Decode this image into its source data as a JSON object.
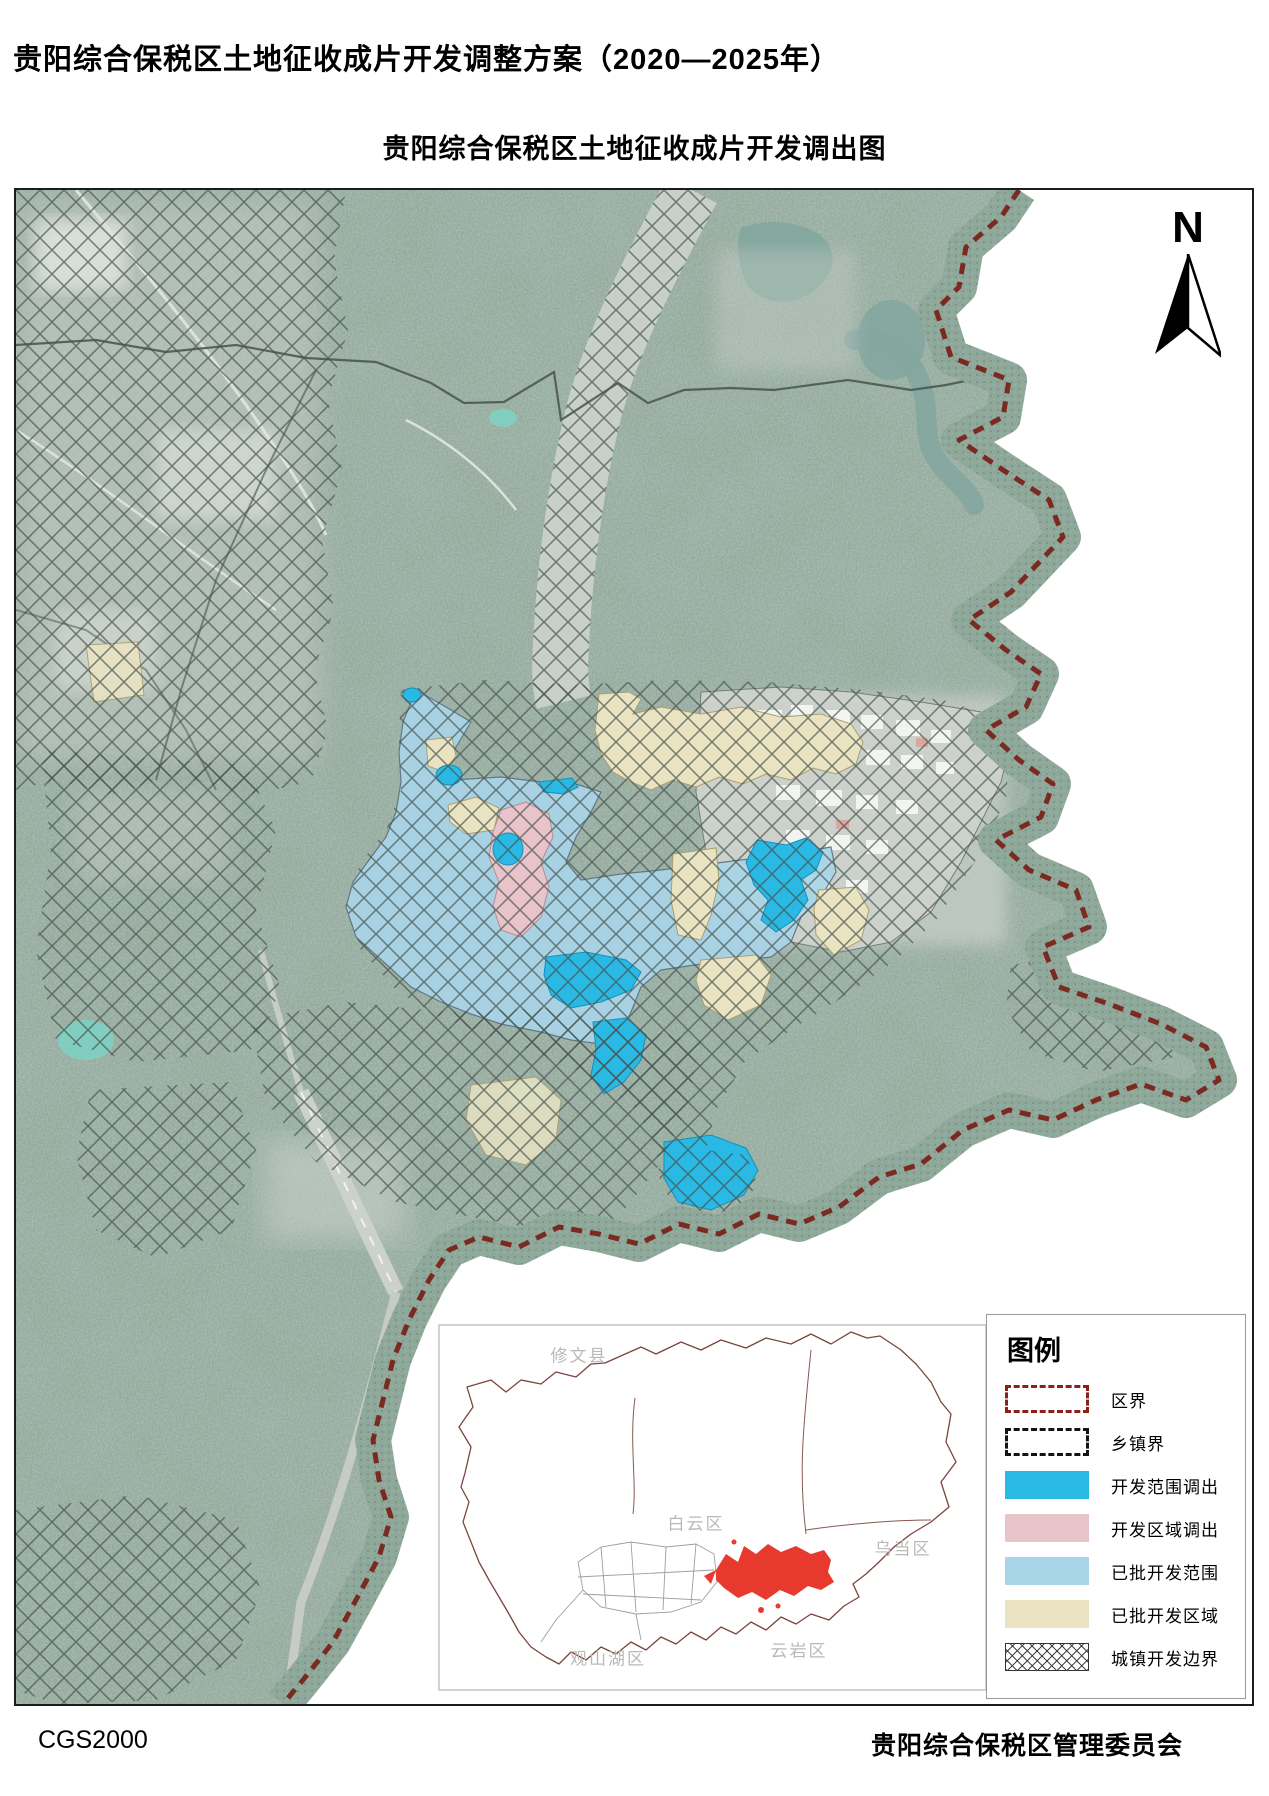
{
  "page": {
    "title": "贵阳综合保税区土地征收成片开发调整方案（2020—2025年）",
    "map_title": "贵阳综合保税区土地征收成片开发调出图",
    "datum": "CGS2000",
    "issuer": "贵阳综合保税区管理委员会"
  },
  "map": {
    "north_label": "N",
    "inset_labels": {
      "xiuwen": "修文县",
      "baiyun": "白云区",
      "wudang": "乌当区",
      "guanshanhu": "观山湖区",
      "yunyan": "云岩区"
    },
    "legend": {
      "title": "图例",
      "items": [
        {
          "label": "区界",
          "swatch": "dashed-red",
          "color": "#8b1f1a"
        },
        {
          "label": "乡镇界",
          "swatch": "dashed-black",
          "color": "#141414"
        },
        {
          "label": "开发范围调出",
          "swatch": "fill-cyan",
          "color": "#29b9e4"
        },
        {
          "label": "开发区域调出",
          "swatch": "fill-pink",
          "color": "#e9c3ca"
        },
        {
          "label": "已批开发范围",
          "swatch": "fill-lblue",
          "color": "#a9d5e8"
        },
        {
          "label": "已批开发区域",
          "swatch": "fill-beige",
          "color": "#e9e3c2"
        },
        {
          "label": "城镇开发边界",
          "swatch": "crosshatch",
          "color": "#3e4a47"
        }
      ]
    }
  }
}
